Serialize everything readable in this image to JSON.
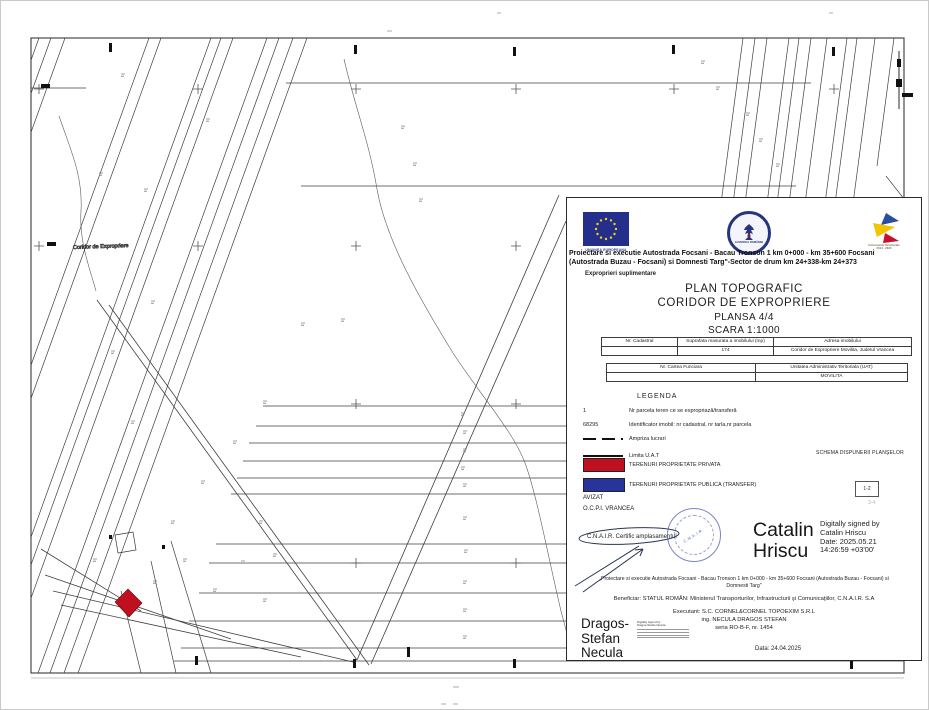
{
  "map": {
    "coridor_label": "Coridor de Expropriere"
  },
  "logos": {
    "eu_icon": "eu-flag-icon",
    "eu_caption": "UNIUNEA EUROPEANA",
    "gov_icon": "romanian-government-emblem-icon",
    "gov_caption": "GUVERNUL ROMÂNIEI",
    "is_icon": "instrumente-structurale-icon",
    "is_caption_line1": "Instrumente Structurale",
    "is_caption_line2": "2014 - 2020"
  },
  "header": {
    "line1": "Proiectare si executie Autostrada Focsani - Bacau Tronson 1 km 0+000 - km 35+600 Focsani",
    "line2": "(Autostrada Buzau - Focsani) si Domnesti Targ\"-Sector de drum km 24+338-km 24+373",
    "subtitle": "Exproprieri suplimentare"
  },
  "title_block": {
    "heading1": "PLAN TOPOGRAFIC",
    "heading2": "CORIDOR DE EXPROPRIERE",
    "heading3": "PLANSA 4/4",
    "heading4": "SCARA 1:1000"
  },
  "table1": {
    "headers": [
      "Nr. Cadastral",
      "Suprafata masurata a imobilului (mp)",
      "Adresa imobilului"
    ],
    "row": [
      "",
      "174",
      "Coridor de Expropriere Movilita, Judetul Vrancea"
    ]
  },
  "table2": {
    "headers": [
      "Nr. Cartea Funciara",
      "Unitatea Administrativ Teritoriala (UAT)"
    ],
    "row": [
      "",
      "MOVILITA"
    ]
  },
  "legend": {
    "title": "LEGENDA",
    "items": [
      {
        "symbol_text": "1",
        "label": "Nr parcela teren ce se expropriază/transferă"
      },
      {
        "symbol_text": "68295",
        "label": "Identificator imobil: nr cadastral, nr tarla,nr parcela"
      },
      {
        "symbol_text": "",
        "label": "Ampriza lucrari"
      },
      {
        "symbol_text": "",
        "label": "Limita U.A.T"
      },
      {
        "symbol_text": "",
        "label": "TERENURI PROPRIETATE PRIVATA",
        "color": "#c00f1e"
      },
      {
        "symbol_text": "",
        "label": "TERENURI PROPRIETATE PUBLICA (TRANSFER)",
        "color": "#28349c"
      }
    ]
  },
  "schema": {
    "title": "SCHEMA DISPUNERII PLANŞELOR",
    "box_label": "1-2",
    "faint_label": "3-4"
  },
  "approvals": {
    "avizat": "AVIZAT",
    "ocpi": "O.C.P.I. VRANCEA",
    "cnair": "C.N.A.I.R.  Certific amplasamentul",
    "stamp_text": "C.N.A.I.R."
  },
  "signature_hriscu": {
    "name": "Catalin Hriscu",
    "d1": "Digitally signed by",
    "d2": "Catalin Hriscu",
    "d3": "Date: 2025.05.21",
    "d4": "14:26:59 +03'00'"
  },
  "footer": {
    "quote_line1": "„Proiectare si executie Autostrada Focsani - Bacau Tronson 1 km 0+000 - km 35+600 Focsani (Autostrada Buzau - Focsani) si",
    "quote_line2": "Domnesti Targ\"",
    "beneficiar": "Beneficiar: STATUL ROMÂN: Ministerul Transporturilor, Infrastructurii şi Comunicaţiilor, C.N.A.I.R. S.A",
    "executant1": "Executant: S.C. CORNEL&CORNEL TOPOEXIM S.R.L",
    "executant2": "ing. NECULA DRAGOS STEFAN",
    "executant3": "seria RO-B-F, nr. 1454",
    "date": "Data: 24.04.2025"
  },
  "signature_necula": {
    "name": "Dragos-Stefan Necula",
    "d1": "Digitally signed by",
    "d2": "Dragos-Stefan Necula"
  },
  "colors": {
    "private_red": "#c00f1e",
    "public_blue": "#28349c",
    "eu_navy": "#232f8b",
    "stamp_blue": "#3e50b4"
  }
}
